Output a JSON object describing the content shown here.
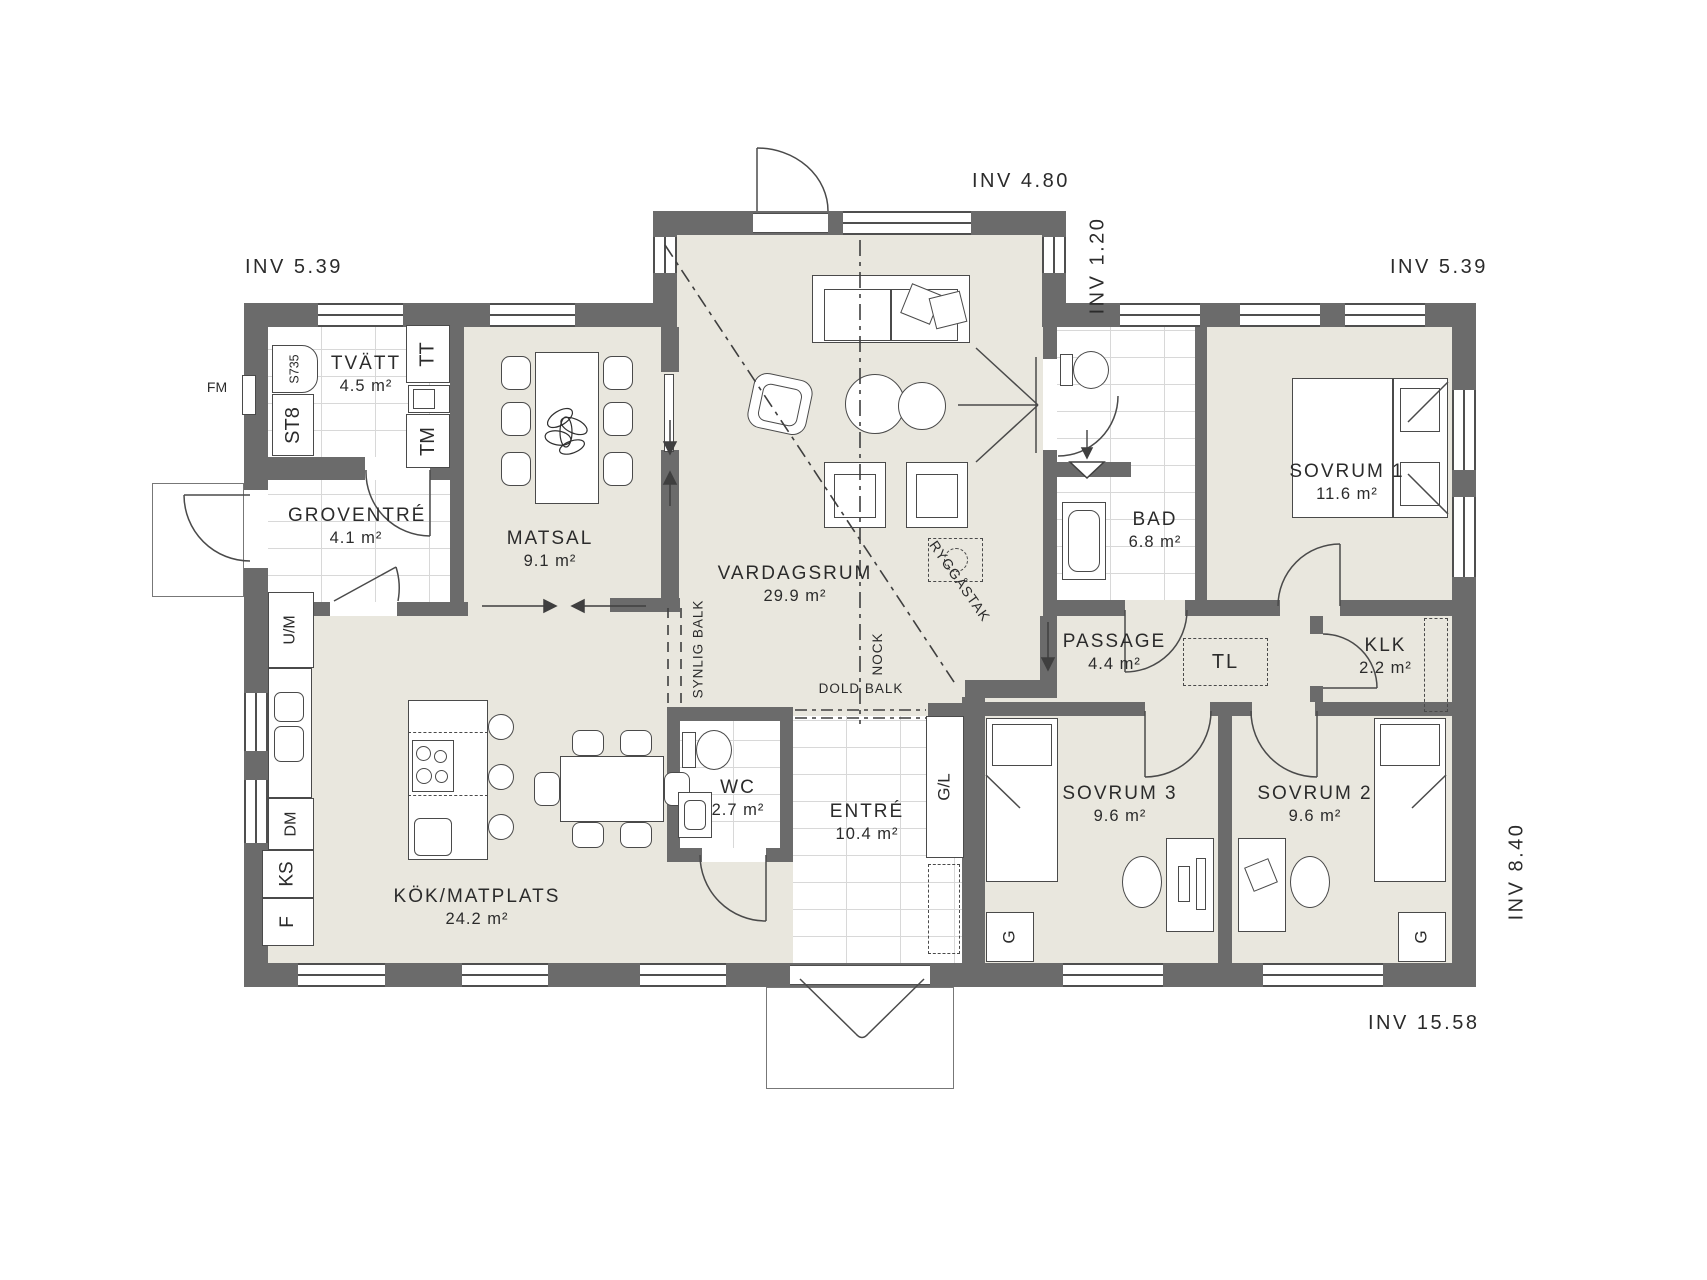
{
  "dimensions": {
    "top_left": "INV 5.39",
    "top_center": "INV 4.80",
    "step": "INV 1.20",
    "top_right": "INV 5.39",
    "right": "INV 8.40",
    "bottom": "INV 15.58"
  },
  "rooms": {
    "tvatt": {
      "name": "TVÄTT",
      "area": "4.5 m²"
    },
    "groventre": {
      "name": "GROVENTRÉ",
      "area": "4.1 m²"
    },
    "matsal": {
      "name": "MATSAL",
      "area": "9.1 m²"
    },
    "vardagsrum": {
      "name": "VARDAGSRUM",
      "area": "29.9 m²"
    },
    "kok": {
      "name": "KÖK/MATPLATS",
      "area": "24.2 m²"
    },
    "wc": {
      "name": "WC",
      "area": "2.7 m²"
    },
    "entre": {
      "name": "ENTRÉ",
      "area": "10.4 m²"
    },
    "bad": {
      "name": "BAD",
      "area": "6.8 m²"
    },
    "sovrum1": {
      "name": "SOVRUM 1",
      "area": "11.6 m²"
    },
    "passage": {
      "name": "PASSAGE",
      "area": "4.4 m²"
    },
    "klk": {
      "name": "KLK",
      "area": "2.2 m²"
    },
    "sovrum3": {
      "name": "SOVRUM 3",
      "area": "9.6 m²"
    },
    "sovrum2": {
      "name": "SOVRUM 2",
      "area": "9.6 m²"
    }
  },
  "fixtures": {
    "fm": "FM",
    "s735": "S735",
    "st8": "ST8",
    "tt": "TT",
    "tm": "TM",
    "um": "U/M",
    "dm": "DM",
    "ks": "KS",
    "f": "F",
    "gl": "G/L",
    "g3": "G",
    "g2": "G",
    "tl": "TL"
  },
  "beams": {
    "synlig": "SYNLIG BALK",
    "nock": "NOCK",
    "dold": "DOLD BALK",
    "rygg": "RYGGÅSTAK"
  },
  "colors": {
    "wall": "#6b6b6b",
    "floor": "#e9e7de",
    "tile_line": "#d8d8d8",
    "stroke": "#4a4a4a"
  }
}
